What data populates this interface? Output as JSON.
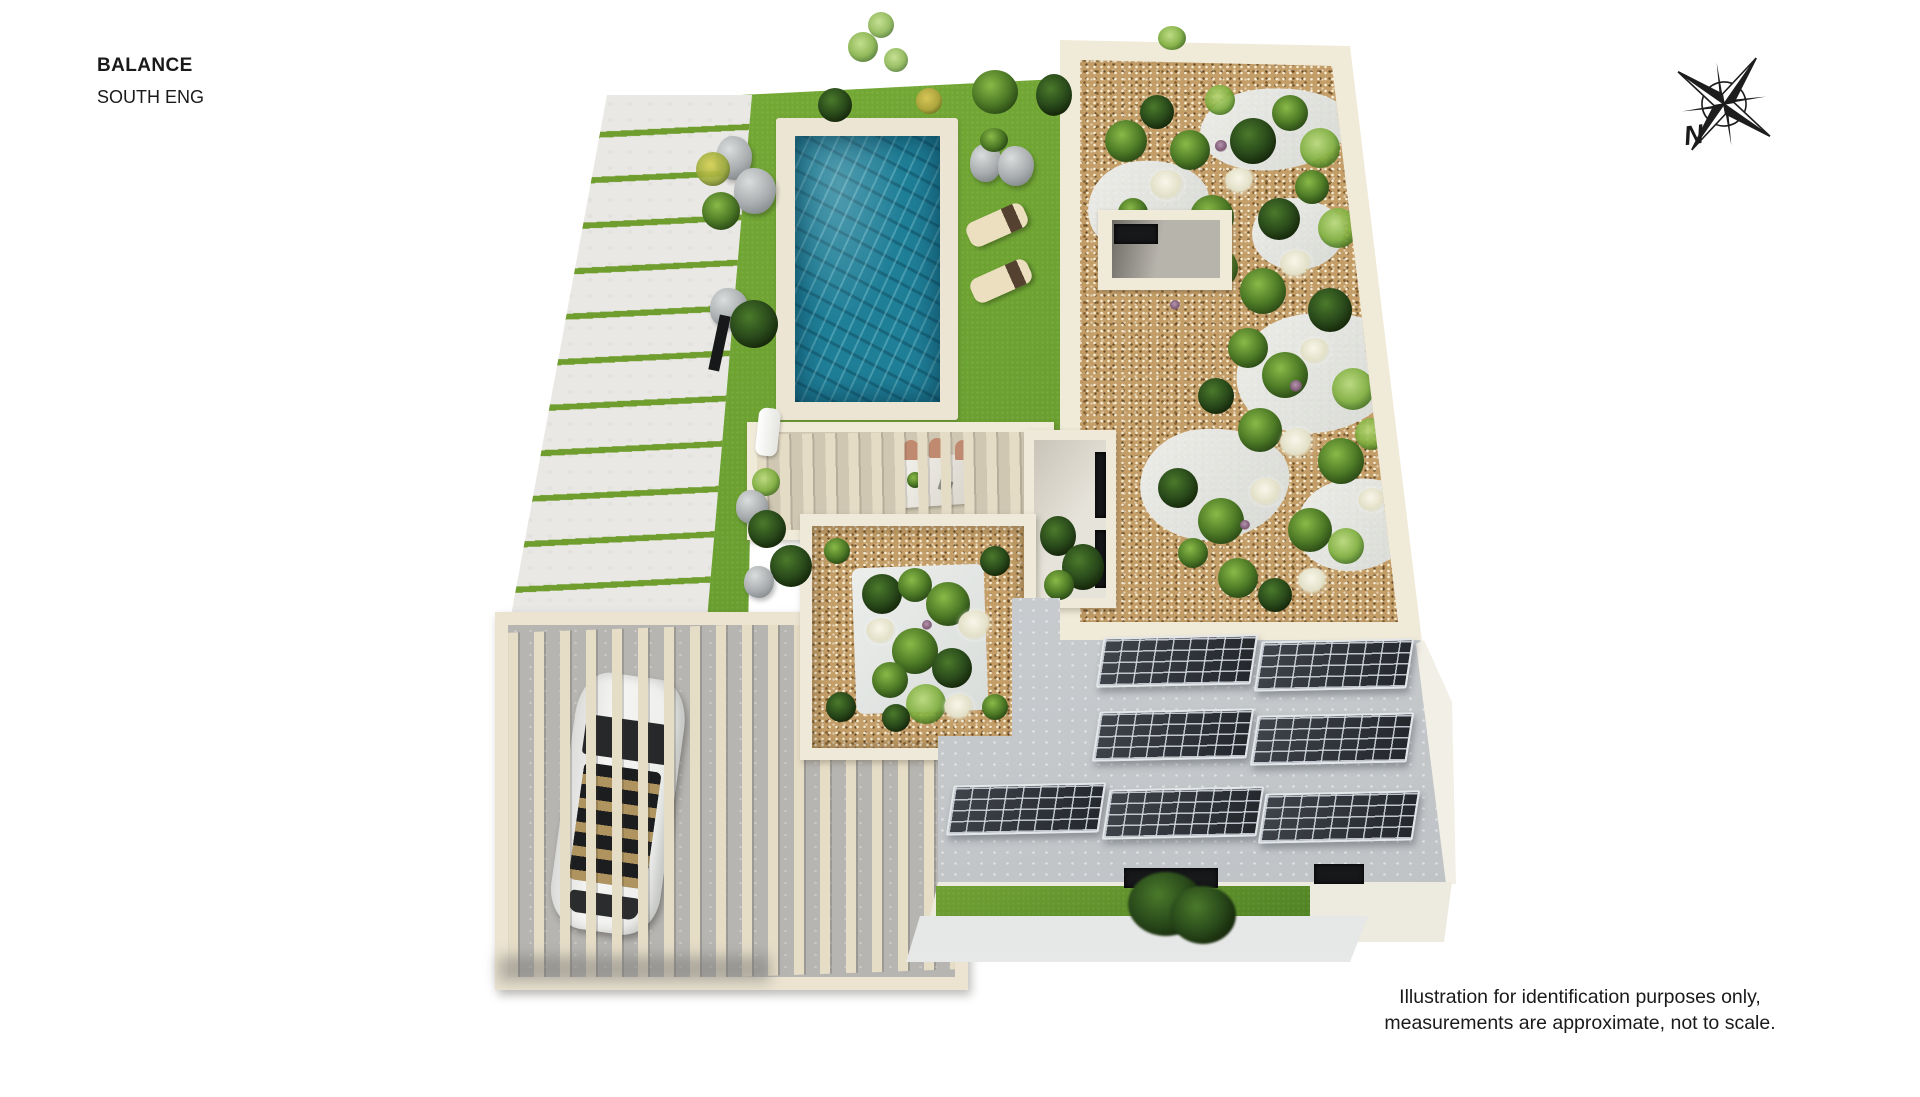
{
  "header": {
    "title": "BALANCE",
    "subtitle": "SOUTH ENG"
  },
  "compass": {
    "label": "N",
    "icon": "compass-rose-icon"
  },
  "disclaimer": {
    "line1": "Illustration for identification purposes only,",
    "line2": "measurements are approximate, not to scale."
  },
  "palette": {
    "background": "#ffffff",
    "text": "#1a1a1a",
    "lawn_green": "#68a12e",
    "grass_strip_green": "#6f9d2e",
    "pavement_grey": "#e9e8e5",
    "pool_water_teal": "#1f7f97",
    "pool_deck_cream": "#ece5d4",
    "gravel_tan": "#c49e68",
    "wall_cream": "#f0ead9",
    "roof_concrete_grey": "#cdd1d4",
    "solar_panel_dark": "#34373c",
    "pergola_slat_cream": "#e5dcc6",
    "car_white": "#f2f2f0",
    "plant_dark_green": "#2c4b17",
    "plant_light_green": "#86b447",
    "flower_white": "#f6f4e8"
  }
}
